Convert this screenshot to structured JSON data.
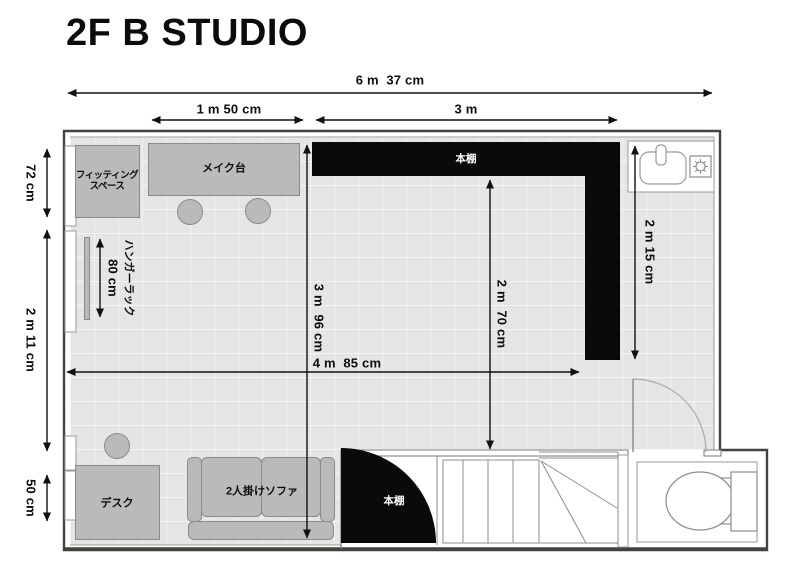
{
  "title": "2F B STUDIO",
  "dimensions": {
    "total_width": "6 m  37 cm",
    "left_width": "1 m 50 cm",
    "right_width": "3 m",
    "wall_top": "72 cm",
    "wall_middle": "2 m 11 cm",
    "wall_bottom": "50 cm",
    "hanger_rack_length": "80 cm",
    "room_depth": "3 m  96 cm",
    "inner_depth": "2 m  70 cm",
    "right_depth": "2 m 15 cm",
    "inner_width": "4 m  85 cm"
  },
  "furniture": {
    "fitting_space": "フィッティング\nスペース",
    "makeup_table": "メイク台",
    "hanger_rack": "ハンガーラック",
    "desk": "デスク",
    "sofa": "2人掛けソファ",
    "bookshelf_top": "本棚",
    "bookshelf_corner": "本棚"
  },
  "fixtures": {
    "sink": "sink-icon",
    "stove": "stove-burner-icon",
    "door": "door-swing-icon",
    "stairs": "stairs-icon",
    "toilet": "toilet-icon",
    "window": "window-icon"
  },
  "colors": {
    "floor": "#e5e5e4",
    "furniture": "#bababa",
    "furniture_border": "#8a8a89",
    "shelf": "#0a0a0a",
    "wall": "#47413d",
    "dimension": "#111111"
  }
}
